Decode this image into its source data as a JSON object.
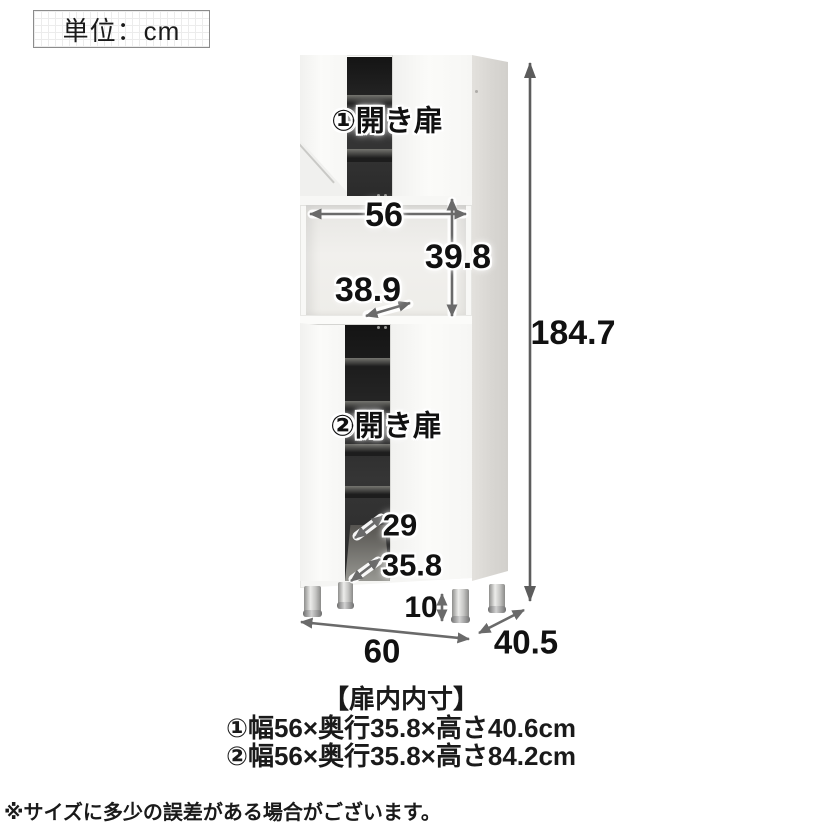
{
  "unit_box": {
    "label": "単位：cm"
  },
  "diagram": {
    "door1_label": "①開き扉",
    "door2_label": "②開き扉",
    "dims": {
      "inner_width": "56",
      "open_section_height": "39.8",
      "open_section_depth": "38.9",
      "total_height": "184.7",
      "lower_inner_depth_a": "29",
      "lower_inner_depth_b": "35.8",
      "leg_height": "10",
      "width": "60",
      "depth": "40.5"
    }
  },
  "specs": {
    "title": "【扉内内寸】",
    "lines": [
      "①幅56×奥行35.8×高さ40.6cm",
      "②幅56×奥行35.8×高さ84.2cm"
    ]
  },
  "footnote": "※サイズに多少の誤差がある場合がございます。",
  "colors": {
    "text": "#1a1a1a",
    "arrow": "#6a6a6a",
    "tall_arrow": "#5c5c5c",
    "cabinet_body": "#f8f8f6",
    "cabinet_side": "#dcdad6",
    "interior_dark": "#222222"
  }
}
